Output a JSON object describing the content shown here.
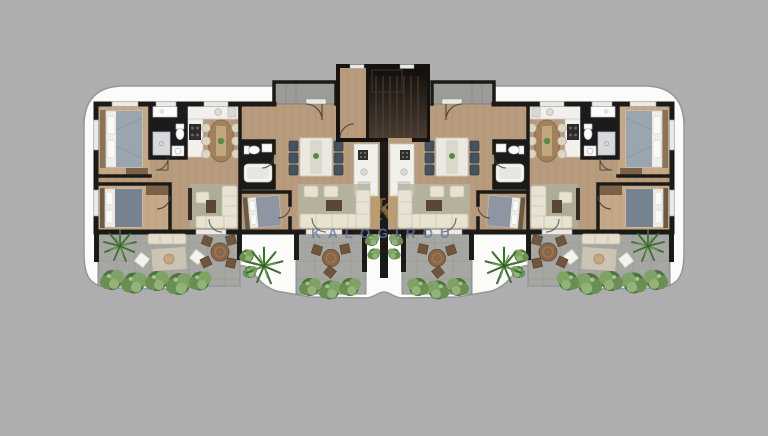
{
  "watermark": {
    "brand": "KALOGIROU",
    "monogram": "K"
  },
  "palette": {
    "background": "#aeaeb0",
    "plate": "#fbfbfa",
    "plate_outline": "#97979a",
    "wall": "#1a1a18",
    "wood_floor": "#b89b7c",
    "wood_floor_light": "#c4a888",
    "terrace_stone": "#a6a6a2",
    "concrete_landing": "#9b9b97",
    "bath_floor": "#1b1b1e",
    "kitchen_counter": "#f1f0ec",
    "sofa_cream": "#e7e2d2",
    "chair_navy": "#46525e",
    "outdoor_table_wood": "#8a674a",
    "bush_green": "#4f7340",
    "palm_green": "#3f7034",
    "monogram_gold": "#c5a050",
    "watermark_blue": "#6576a3",
    "bed_blue": "#8d9aa7"
  }
}
